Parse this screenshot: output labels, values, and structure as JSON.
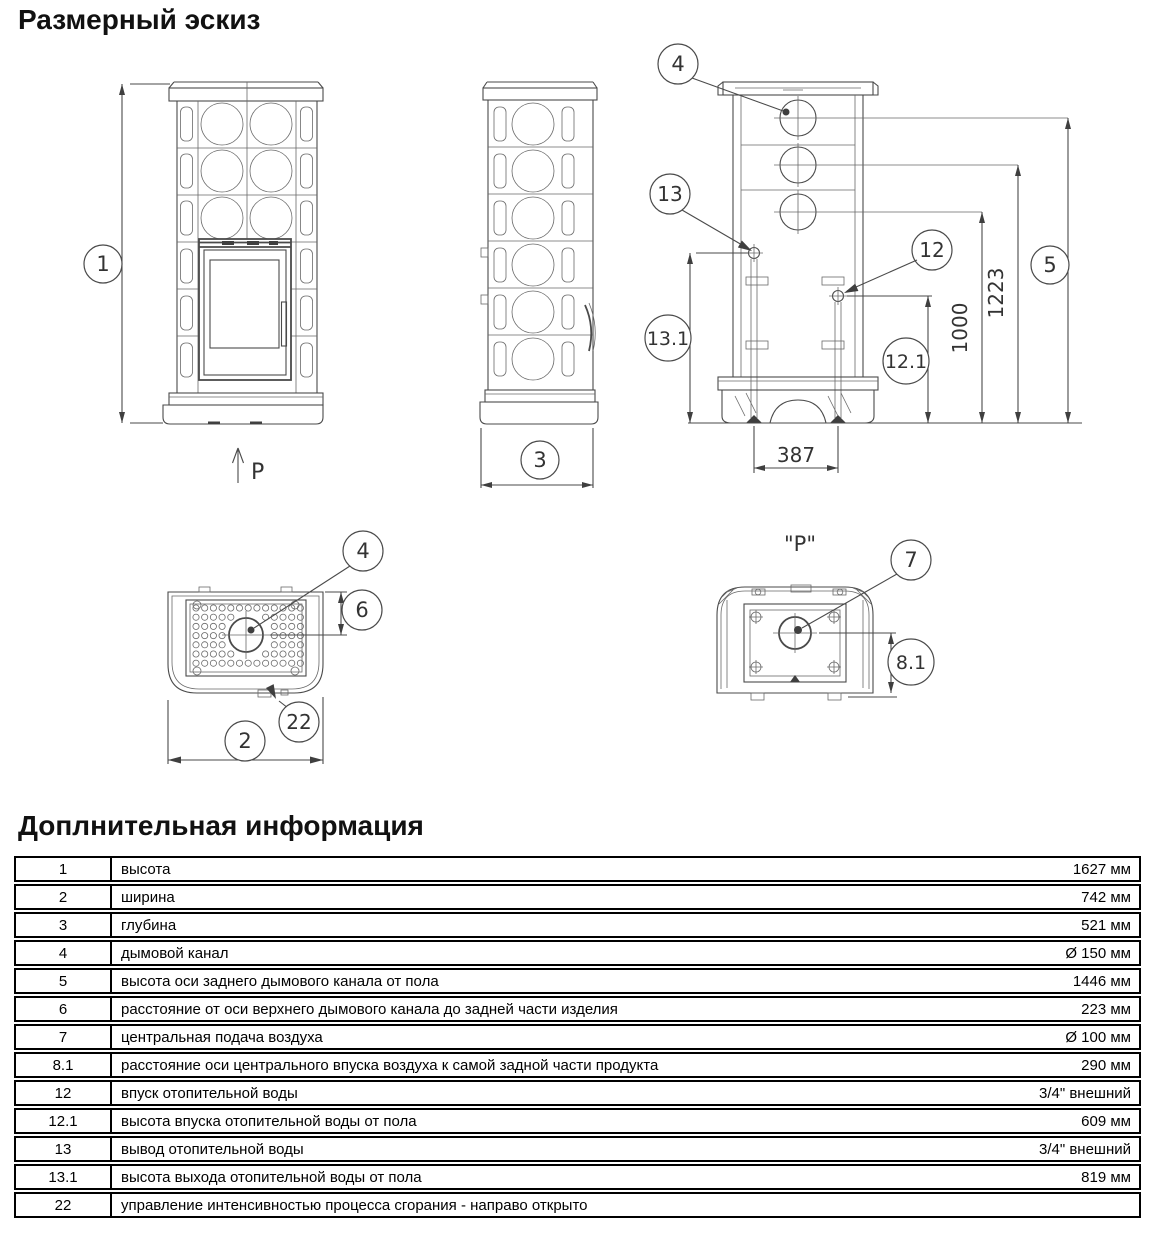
{
  "page": {
    "title1": "Размерный эскиз",
    "title2": "Доплнительная информация"
  },
  "drawing": {
    "front": {
      "balloon_height": "1",
      "direction_label": "P"
    },
    "side": {
      "balloon_depth": "3"
    },
    "rear": {
      "balloon_flue": "4",
      "balloon_water_outlet": "13",
      "balloon_water_inlet": "12",
      "balloon_flue_height": "5",
      "balloon_outlet_height": "13.1",
      "balloon_inlet_height": "12.1",
      "dim_1223": "1223",
      "dim_1000": "1000",
      "dim_387": "387"
    },
    "top": {
      "balloon_flue": "4",
      "balloon_flue_offset": "6",
      "balloon_width": "2",
      "balloon_control": "22"
    },
    "bottom": {
      "view_title": "\"P\"",
      "balloon_air": "7",
      "balloon_air_offset": "8.1"
    }
  },
  "table": {
    "rows": [
      {
        "num": "1",
        "desc": "высота",
        "value": "1627 мм"
      },
      {
        "num": "2",
        "desc": "ширина",
        "value": "742 мм"
      },
      {
        "num": "3",
        "desc": "глубина",
        "value": "521 мм"
      },
      {
        "num": "4",
        "desc": "дымовой канал",
        "value": "Ø 150 мм"
      },
      {
        "num": "5",
        "desc": "высота оси заднего дымового канала от пола",
        "value": "1446 мм"
      },
      {
        "num": "6",
        "desc": "расстояние от оси верхнего дымового канала до задней части изделия",
        "value": "223 мм"
      },
      {
        "num": "7",
        "desc": "центральная подача воздуха",
        "value": "Ø 100 мм"
      },
      {
        "num": "8.1",
        "desc": "расстояние оси центрального впуска воздуха к самой задной части продукта",
        "value": "290 мм"
      },
      {
        "num": "12",
        "desc": "впуск отопительной воды",
        "value": "3/4\" внешний"
      },
      {
        "num": "12.1",
        "desc": "высота впуска отопительной воды от пола",
        "value": "609 мм"
      },
      {
        "num": "13",
        "desc": "вывод отопительной воды",
        "value": "3/4\" внешний"
      },
      {
        "num": "13.1",
        "desc": "высота выхода отопительной воды от пола",
        "value": "819 мм"
      },
      {
        "num": "22",
        "desc": "управление интенсивностью процесса сгорания - направо открыто",
        "value": ""
      }
    ]
  }
}
